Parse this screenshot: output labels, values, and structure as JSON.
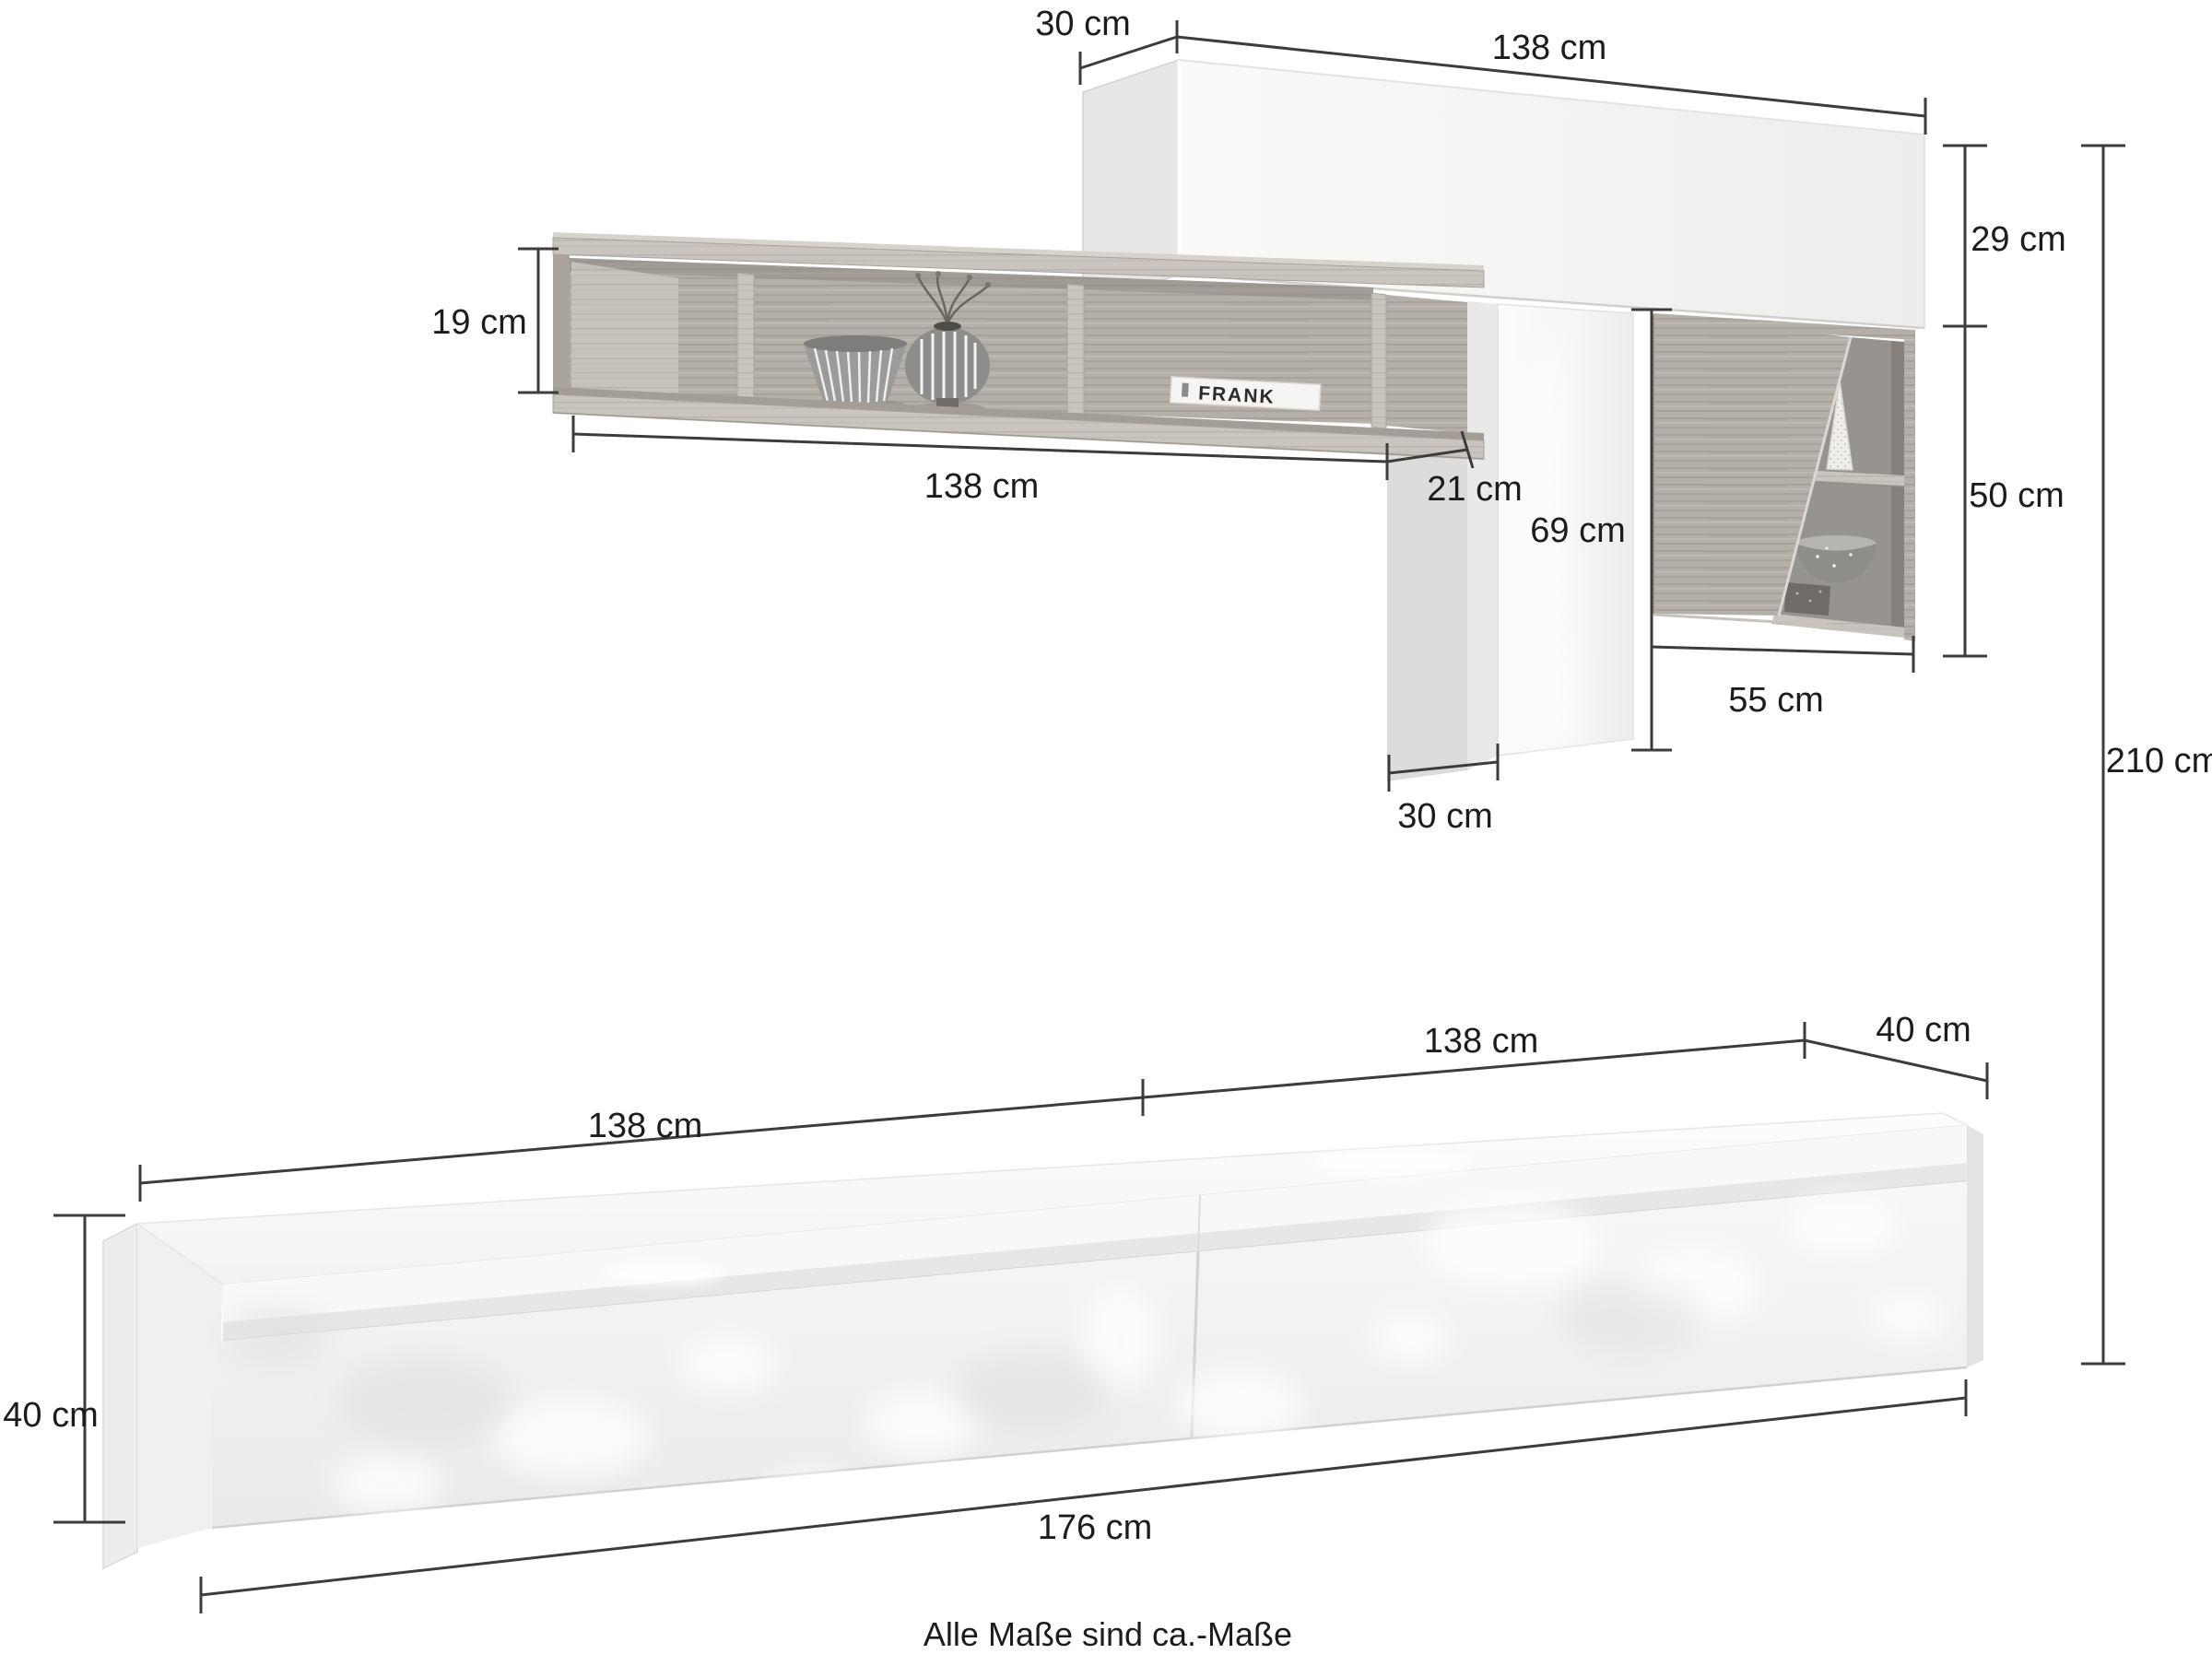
{
  "diagram": {
    "caption": "Alle Maße sind ca.-Maße",
    "unit": "cm",
    "top_unit": {
      "upper_cabinet_depth": "30 cm",
      "upper_cabinet_width": "138 cm",
      "upper_cabinet_height": "29 cm",
      "wall_shelf_height": "19 cm",
      "wall_shelf_width": "138 cm",
      "wall_shelf_overhang_depth": "21 cm",
      "side_panel_height": "69 cm",
      "side_panel_depth": "30 cm",
      "display_cabinet_height": "50 cm",
      "display_cabinet_width": "55 cm",
      "total_height": "210 cm"
    },
    "lowboard": {
      "left_section_width": "138 cm",
      "right_section_width": "138 cm",
      "depth": "40 cm",
      "height": "40 cm",
      "total_width": "176 cm"
    },
    "decor": {
      "book_spine": "FRANK"
    }
  },
  "colors": {
    "background": "#ffffff",
    "dimension_line": "#3c3c3c",
    "text": "#1c1c1c",
    "white_furniture": "#f5f5f4",
    "wood": "#b4b0a9",
    "wood_light": "#c9c5be",
    "compartment_dark": "#97938e"
  }
}
